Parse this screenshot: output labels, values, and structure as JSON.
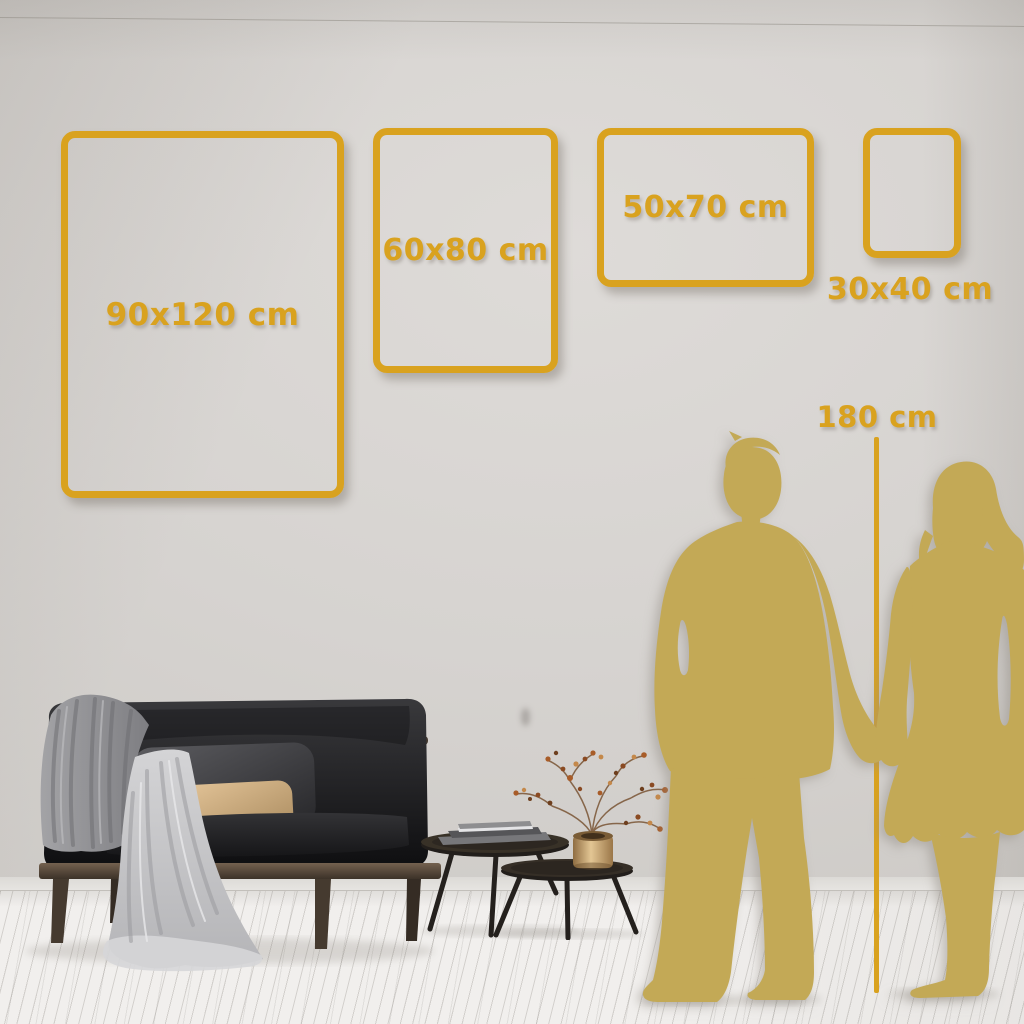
{
  "frames": [
    {
      "id": "90x120",
      "label": "90x120 cm"
    },
    {
      "id": "60x80",
      "label": "60x80 cm"
    },
    {
      "id": "50x70",
      "label": "50x70 cm"
    },
    {
      "id": "30x40",
      "label": "30x40 cm"
    }
  ],
  "height_reference": {
    "label": "180 cm"
  },
  "colors": {
    "accent_gold": "#D9A21F",
    "silhouette_gold": "#C3A956",
    "wall": "#D5D2CF",
    "floor": "#F1EFED",
    "sofa_black": "#1C1C1E",
    "wood_brown": "#54453A",
    "vase_gold": "#C9A66B"
  },
  "illustrations": {
    "couple": "couple-holding-hands-silhouette",
    "sofa": "dark-loveseat-with-throw-and-pillows",
    "tables": "nesting-coffee-tables-with-books",
    "plant": "dried-berry-branch-in-gold-vase"
  }
}
